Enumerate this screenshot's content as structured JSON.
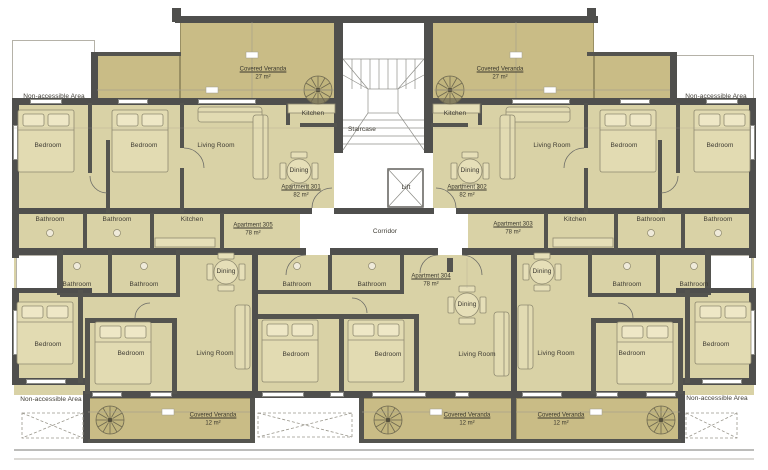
{
  "labels": {
    "non_accessible": "Non-accessible Area",
    "staircase": "Staircase",
    "lift": "Lift",
    "corridor": "Corridor",
    "bedroom": "Bedroom",
    "living_room": "Living Room",
    "dining": "Dining",
    "kitchen": "Kitchen",
    "bathroom": "Bathroom"
  },
  "verandas": {
    "top_left": {
      "name": "Covered Veranda",
      "area": "27 m²"
    },
    "top_right": {
      "name": "Covered Veranda",
      "area": "27 m²"
    },
    "bottom_left": {
      "name": "Covered Veranda",
      "area": "12 m²"
    },
    "bottom_center": {
      "name": "Covered Veranda",
      "area": "12 m²"
    },
    "bottom_right": {
      "name": "Covered Veranda",
      "area": "12 m²"
    }
  },
  "apartments": {
    "a301": {
      "name": "Apartment 301",
      "area": "82 m²"
    },
    "a302": {
      "name": "Apartment 302",
      "area": "82 m²"
    },
    "a303": {
      "name": "Apartment 303",
      "area": "78 m²"
    },
    "a304": {
      "name": "Apartment 304",
      "area": "78 m²"
    },
    "a305": {
      "name": "Apartment 305",
      "area": "78 m²"
    }
  },
  "colors": {
    "wall": "#4f4f4d",
    "room_fill": "#d9d2a6",
    "veranda_fill": "#c9bc86",
    "background": "#ffffff"
  }
}
